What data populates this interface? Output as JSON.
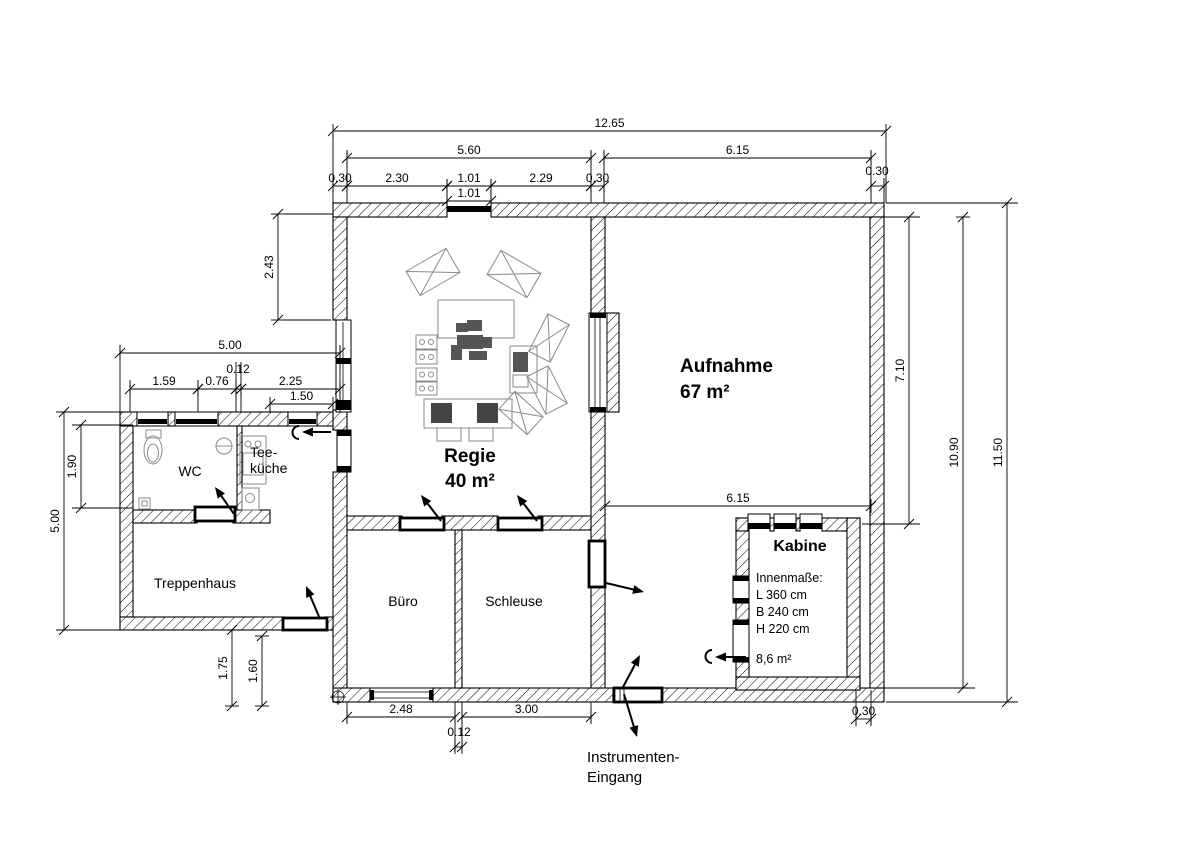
{
  "rooms": {
    "regie": {
      "name": "Regie",
      "area": "40 m²"
    },
    "aufnahme": {
      "name": "Aufnahme",
      "area": "67 m²"
    },
    "kabine": {
      "name": "Kabine",
      "dims_title": "Innenmaße:",
      "length": "L 360 cm",
      "width": "B 240 cm",
      "height": "H 220 cm",
      "area": "8,6 m²"
    },
    "wc": {
      "name": "WC"
    },
    "teekueche": {
      "name_line1": "Tee-",
      "name_line2": "küche"
    },
    "treppenhaus": {
      "name": "Treppenhaus"
    },
    "buero": {
      "name": "Büro"
    },
    "schleuse": {
      "name": "Schleuse"
    }
  },
  "annotations": {
    "instrumenten_eingang_line1": "Instrumenten-",
    "instrumenten_eingang_line2": "Eingang"
  },
  "colors": {
    "line": "#000000",
    "furniture": "#8a8a8a",
    "background": "#ffffff"
  },
  "dimensions": [
    {
      "text": "12.65",
      "orient": "h",
      "a": 333,
      "b": 886,
      "p": 131
    },
    {
      "text": "5.60",
      "orient": "h",
      "a": 347,
      "b": 591,
      "p": 158
    },
    {
      "text": "6.15",
      "orient": "h",
      "a": 604,
      "b": 871,
      "p": 158
    },
    {
      "text": "0.30",
      "orient": "h",
      "a": 333,
      "b": 347,
      "p": 186
    },
    {
      "text": "2.30",
      "orient": "h",
      "a": 347,
      "b": 447,
      "p": 186
    },
    {
      "text": "1.01",
      "orient": "h",
      "a": 447,
      "b": 491,
      "p": 186
    },
    {
      "text": "2.29",
      "orient": "h",
      "a": 491,
      "b": 591,
      "p": 186
    },
    {
      "text": "0.30",
      "orient": "h",
      "a": 591,
      "b": 604,
      "p": 186
    },
    {
      "text": "0.30",
      "orient": "h",
      "a": 871,
      "b": 884,
      "p": 186,
      "lx": 877,
      "ly": 175
    },
    {
      "text": "1.01",
      "orient": "h",
      "a": 447,
      "b": 491,
      "p": 201
    },
    {
      "text": "5.00",
      "orient": "h",
      "a": 120,
      "b": 340,
      "p": 353
    },
    {
      "text": "1.59",
      "orient": "h",
      "a": 130,
      "b": 198,
      "p": 389
    },
    {
      "text": "0.76",
      "orient": "h",
      "a": 198,
      "b": 236,
      "p": 389
    },
    {
      "text": "0.12",
      "orient": "h",
      "a": 236,
      "b": 241,
      "p": 389,
      "lx": 238,
      "ly": 373
    },
    {
      "text": "2.25",
      "orient": "h",
      "a": 241,
      "b": 340,
      "p": 389
    },
    {
      "text": "1.50",
      "orient": "h",
      "a": 270,
      "b": 333,
      "p": 404
    },
    {
      "text": "6.15",
      "orient": "h",
      "a": 605,
      "b": 871,
      "p": 506
    },
    {
      "text": "2.48",
      "orient": "h",
      "a": 347,
      "b": 455,
      "p": 717
    },
    {
      "text": "3.00",
      "orient": "h",
      "a": 462,
      "b": 591,
      "p": 717
    },
    {
      "text": "0.12",
      "orient": "h",
      "a": 455,
      "b": 462,
      "p": 747,
      "lx": 459,
      "ly": 736
    },
    {
      "text": "0.30",
      "orient": "h",
      "a": 856,
      "b": 871,
      "p": 719
    },
    {
      "text": "2.43",
      "orient": "v",
      "a": 214,
      "b": 320,
      "p": 278
    },
    {
      "text": "1.90",
      "orient": "v",
      "a": 425,
      "b": 508,
      "p": 81
    },
    {
      "text": "5.00",
      "orient": "v",
      "a": 412,
      "b": 630,
      "p": 64
    },
    {
      "text": "1.75",
      "orient": "v",
      "a": 630,
      "b": 706,
      "p": 232
    },
    {
      "text": "1.60",
      "orient": "v",
      "a": 636,
      "b": 706,
      "p": 262
    },
    {
      "text": "7.10",
      "orient": "v",
      "a": 217,
      "b": 524,
      "p": 909
    },
    {
      "text": "10.90",
      "orient": "v",
      "a": 217,
      "b": 688,
      "p": 963
    },
    {
      "text": "11.50",
      "orient": "v",
      "a": 203,
      "b": 702,
      "p": 1007
    }
  ]
}
